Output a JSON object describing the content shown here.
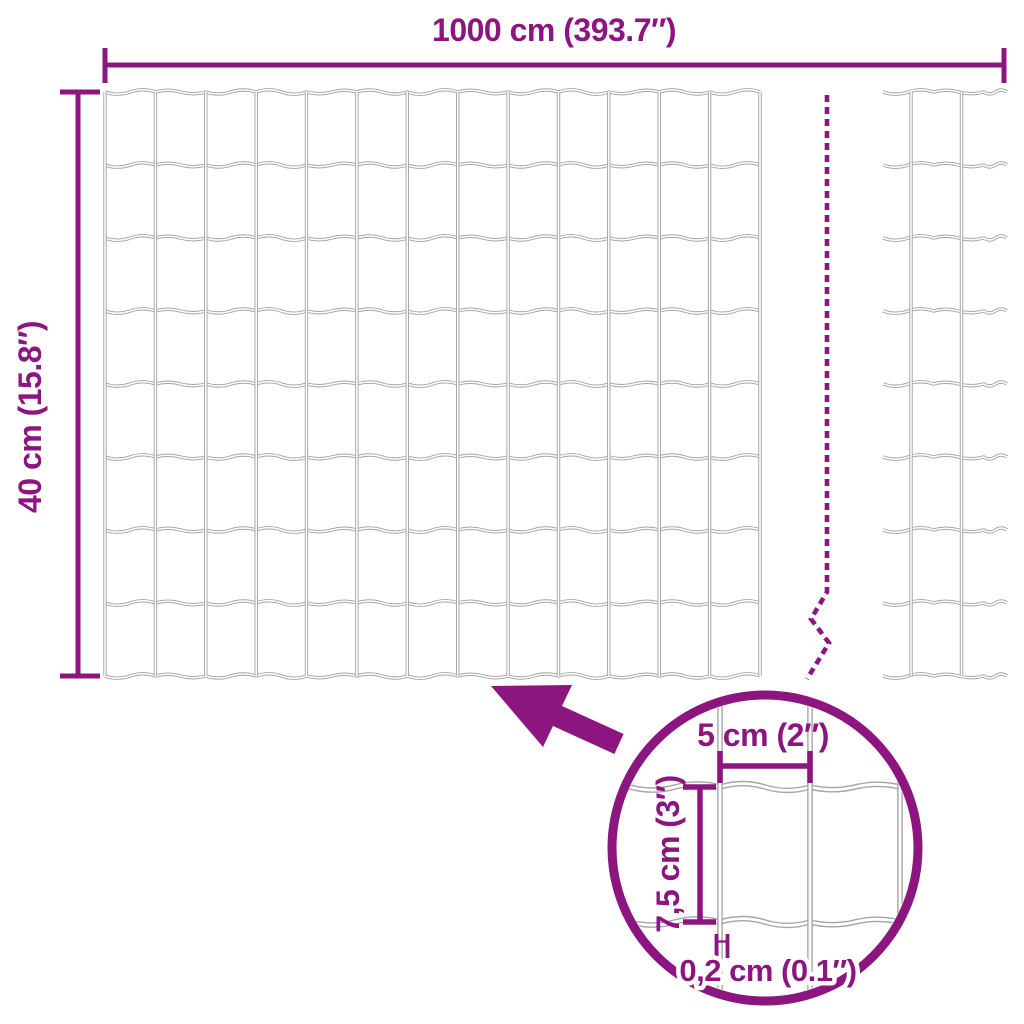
{
  "colors": {
    "accent": "#8C1580",
    "wire": "#A5A5A5",
    "wire_core": "#FFFFFF",
    "background": "#FFFFFF"
  },
  "labels": {
    "total_width": "1000 cm (393.7″)",
    "total_height": "40 cm (15.8″)",
    "mesh_width": "5 cm (2″)",
    "mesh_height": "7,5 cm (3″)",
    "wire_thickness": "0,2 cm (0.1″)"
  }
}
